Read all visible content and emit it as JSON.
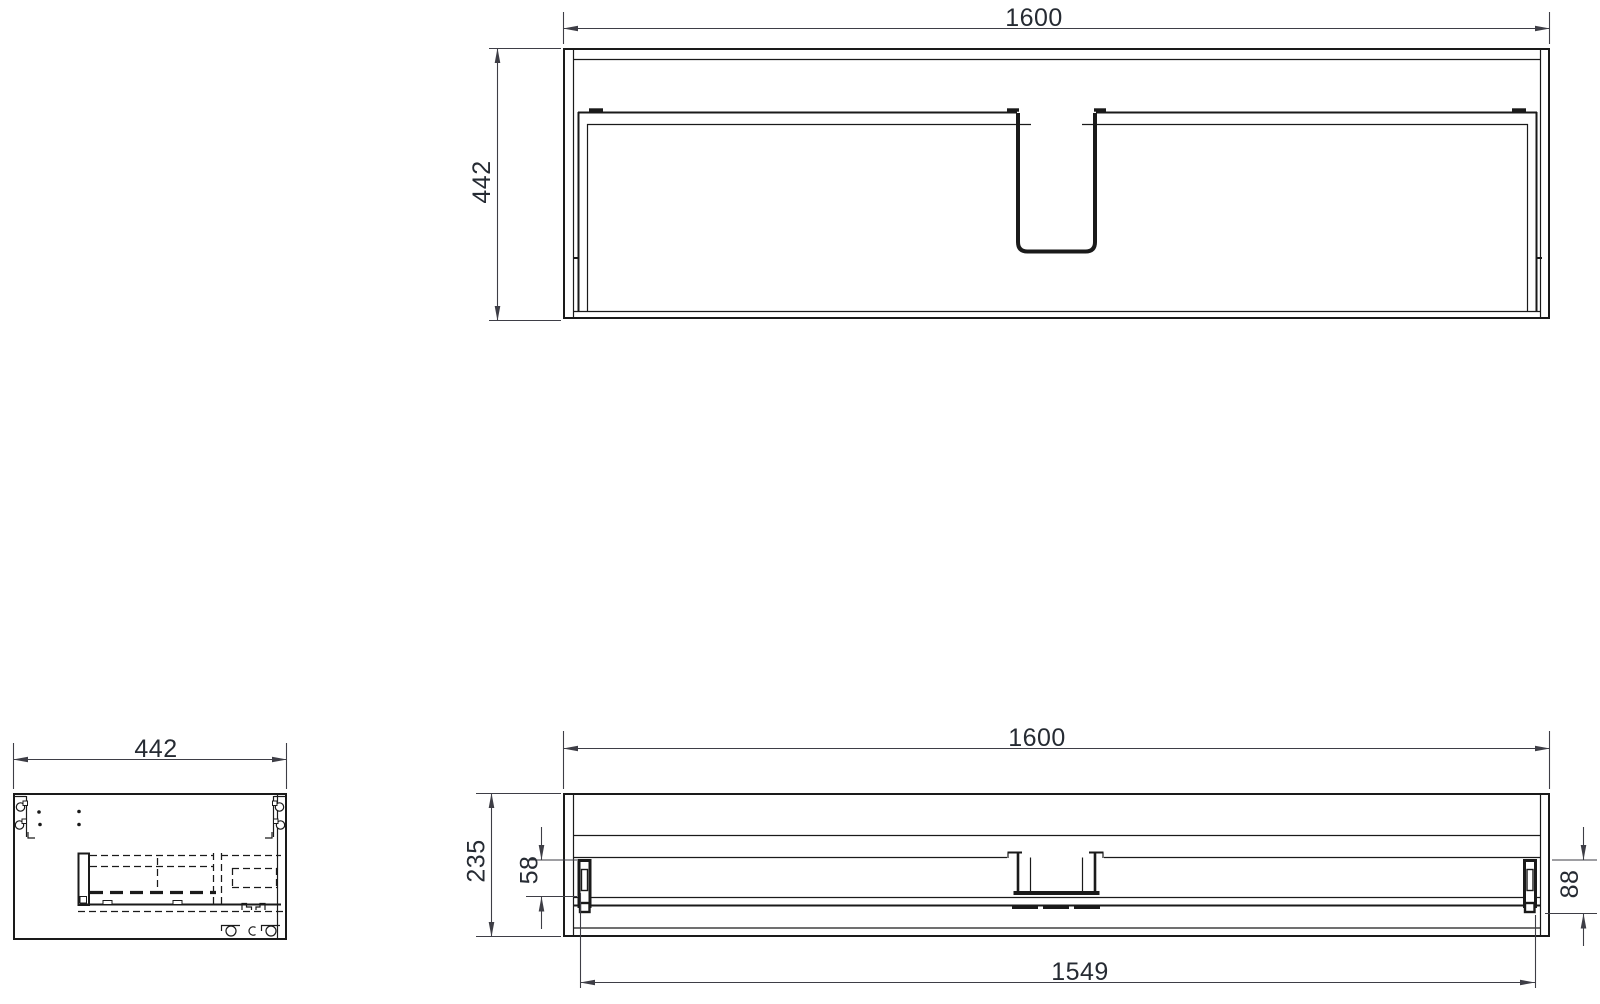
{
  "drawing": {
    "type": "technical-drawing-three-views",
    "colors": {
      "background": "#ffffff",
      "edge_line": "#1a1a1a",
      "dimension_line": "#3e3e46",
      "dimension_text": "#262b33"
    },
    "views": {
      "plan": {
        "width": "1600",
        "depth": "442"
      },
      "side": {
        "depth": "442"
      },
      "front": {
        "width": "1600",
        "height": "235",
        "drawer_front_offset": "58",
        "runner_height": "88",
        "inner_width": "1549"
      }
    }
  }
}
